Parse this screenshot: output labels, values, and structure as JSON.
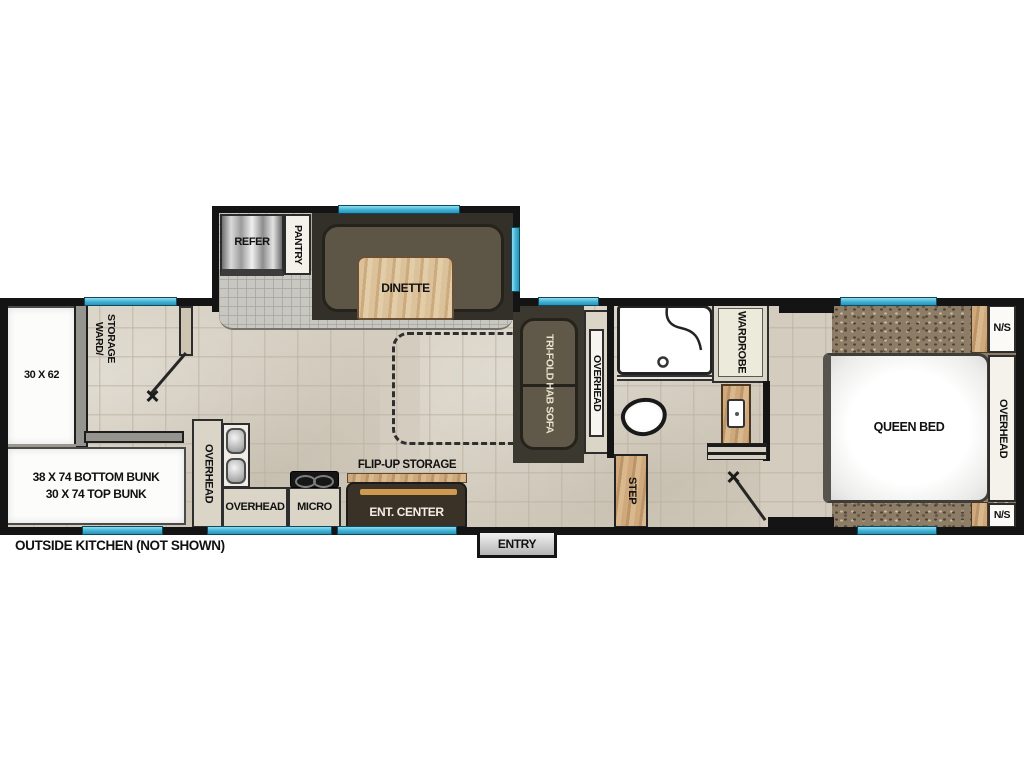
{
  "fp": {
    "slide": {
      "refer": "REFER",
      "pantry": "PANTRY",
      "dinette": "DINETTE"
    },
    "front": {
      "bed": "30 X 62",
      "ward": "WARD/\nSTORAGE",
      "bunk": "38 X 74 BOTTOM BUNK\n30 X 74 TOP BUNK"
    },
    "kitchen": {
      "overhead_v": "OVERHEAD",
      "overhead_h": "OVERHEAD",
      "micro": "MICRO",
      "flip_up": "FLIP-UP STORAGE",
      "ent_center": "ENT. CENTER"
    },
    "living": {
      "sofa": "TRI-FOLD HAB SOFA",
      "overhead": "OVERHEAD"
    },
    "bath": {
      "wardrobe": "WARDROBE",
      "step": "STEP"
    },
    "bedroom": {
      "bed": "QUEEN BED",
      "overhead": "OVERHEAD",
      "ns_top": "N/S",
      "ns_bottom": "N/S"
    },
    "entry": "ENTRY",
    "footnote": "OUTSIDE KITCHEN (NOT SHOWN)"
  },
  "colors": {
    "wall": "#141414",
    "window_accent": "#3fb0d4",
    "floor_tile": "#d4cdbf",
    "slide_floor": "#c8c7c2",
    "carpet": "#8d7d67",
    "wood": "#cfa97c",
    "cabinet": "#dad5c7",
    "sofa_cushion": "#5d5647",
    "ent_center": "#3a3127",
    "ent_accent": "#cf9a50"
  }
}
